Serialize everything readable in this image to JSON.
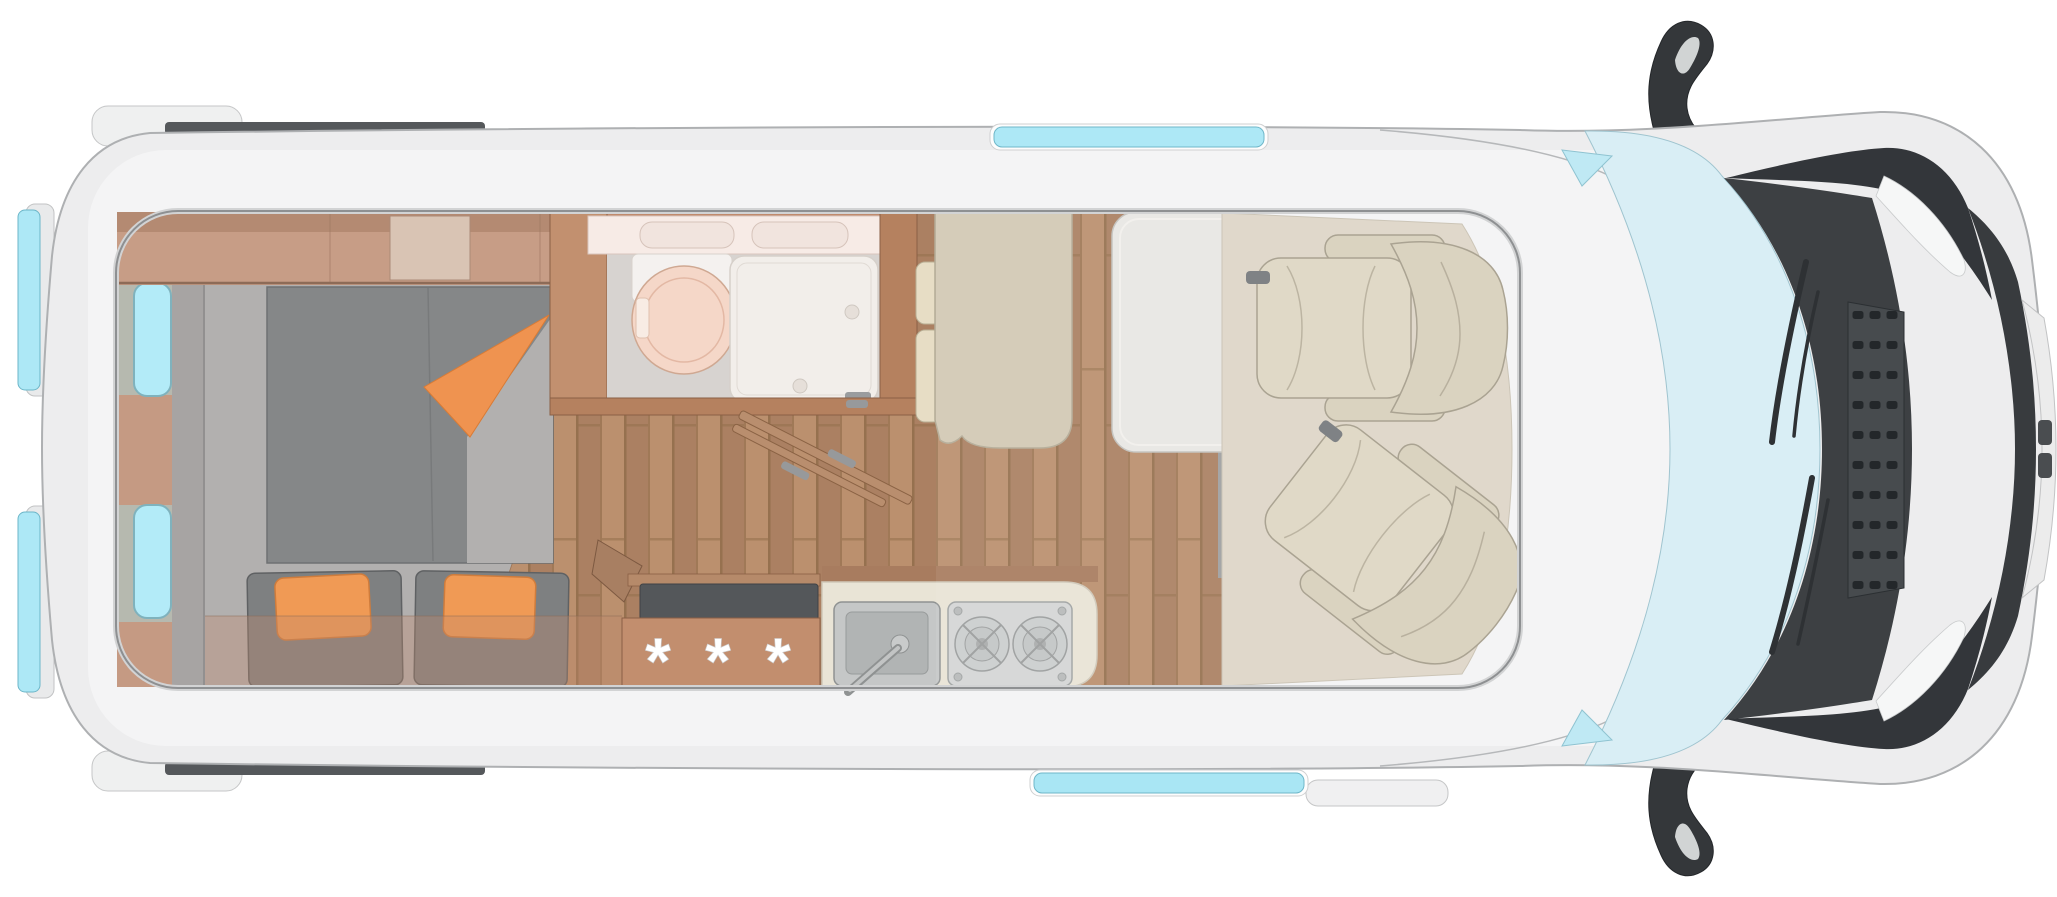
{
  "scene": {
    "title": "Camper van floor plan — top view",
    "background": "#ffffff"
  },
  "colors": {
    "body": "#ededee",
    "body_outline": "#aeb0b2",
    "roof_panel": "#f4f4f5",
    "glass": "#ade8f6",
    "windshield": "#d9eef5",
    "dark_trim": "#3d4043",
    "wood_furniture": "#c28e6e",
    "wood_wall": "#c2906f",
    "wood_floor": "#b48a69",
    "bed_gray": "#858788",
    "floor_gray": "#b2b0af",
    "accent_orange": "#ef9350",
    "pillow_orange": "#f09a55",
    "cushion_gray": "#7e8081",
    "bench_khaki": "#d2c9b4",
    "pad_tan": "#e7ddc5",
    "seat_beige": "#ded7c3",
    "cab_floor": "#ded6c7",
    "table_gray": "#e8e7e3",
    "counter_cream": "#e9e4d6",
    "steel": "#c5c7c7",
    "worktop_dark": "#54575a",
    "shower_white": "#f2eeea",
    "toilet_peach": "#f5d7c8"
  },
  "kitchen": {
    "wardrobe_label": "* * *",
    "burner_count": 2,
    "sink_count": 1
  },
  "bathroom": {
    "basin_count": 2,
    "toilet_count": 1,
    "shower_count": 1
  },
  "windows": {
    "rear_door_windows": 2,
    "side_wall_windows": 2,
    "roof_edge_window_strips": 2
  },
  "seating": {
    "cab_seats": 2,
    "bench_backrest_pads": 2,
    "sofa_pillows": 2,
    "sofa_cushions": 2
  }
}
